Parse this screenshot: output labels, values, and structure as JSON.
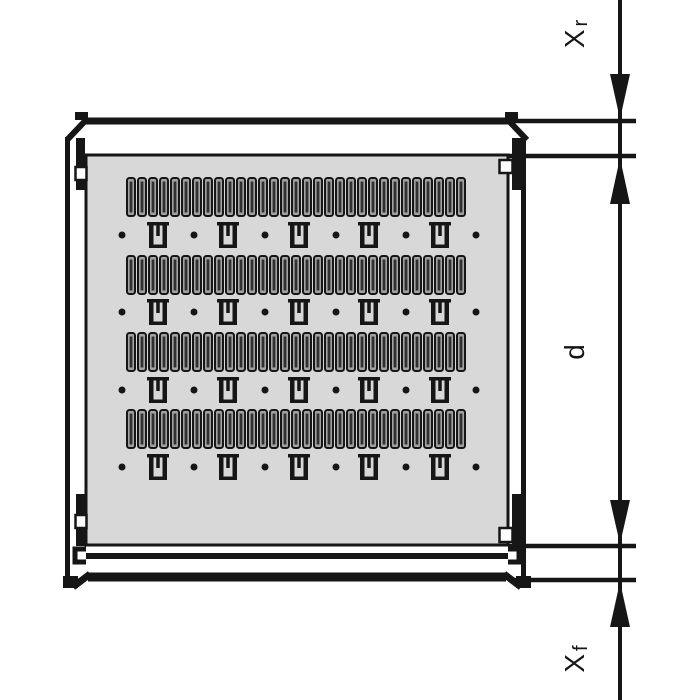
{
  "diagram": {
    "type": "technical-drawing",
    "description": "Top view of a rack shelf / gliding shelf with ventilation slot pattern and vertical depth dimension chain",
    "colors": {
      "line": "#161616",
      "panel_fill": "#d8d8d8",
      "slot_fill": "#a3a3a3",
      "slot_core": "#303030",
      "background": "#ffffff"
    },
    "dimension_labels": [
      {
        "id": "rear-clearance",
        "main": "X",
        "sub": "r",
        "center_y": 34
      },
      {
        "id": "depth",
        "main": "d",
        "sub": "",
        "center_y": 352
      },
      {
        "id": "front-clearance",
        "main": "X",
        "sub": "f",
        "center_y": 659
      }
    ],
    "dimension_geometry": {
      "line_x": 620,
      "tick_y": [
        121,
        156,
        546,
        580
      ],
      "tick_x_start": 509,
      "tick_x_end": 636
    },
    "vent_pattern": {
      "slot_rows_top_y": [
        178,
        256,
        333,
        410
      ],
      "slot_height": 38,
      "slot_width": 8,
      "slot_pitch": 11,
      "slots_per_row": 31,
      "first_slot_x": 127,
      "clip_rows_center_y": [
        235,
        312,
        390,
        467
      ],
      "dot_centers_x": [
        122,
        194,
        265,
        336,
        406,
        476
      ],
      "clip_centers_x": [
        158,
        228,
        299,
        369,
        440
      ],
      "dot_radius": 3.5
    }
  }
}
